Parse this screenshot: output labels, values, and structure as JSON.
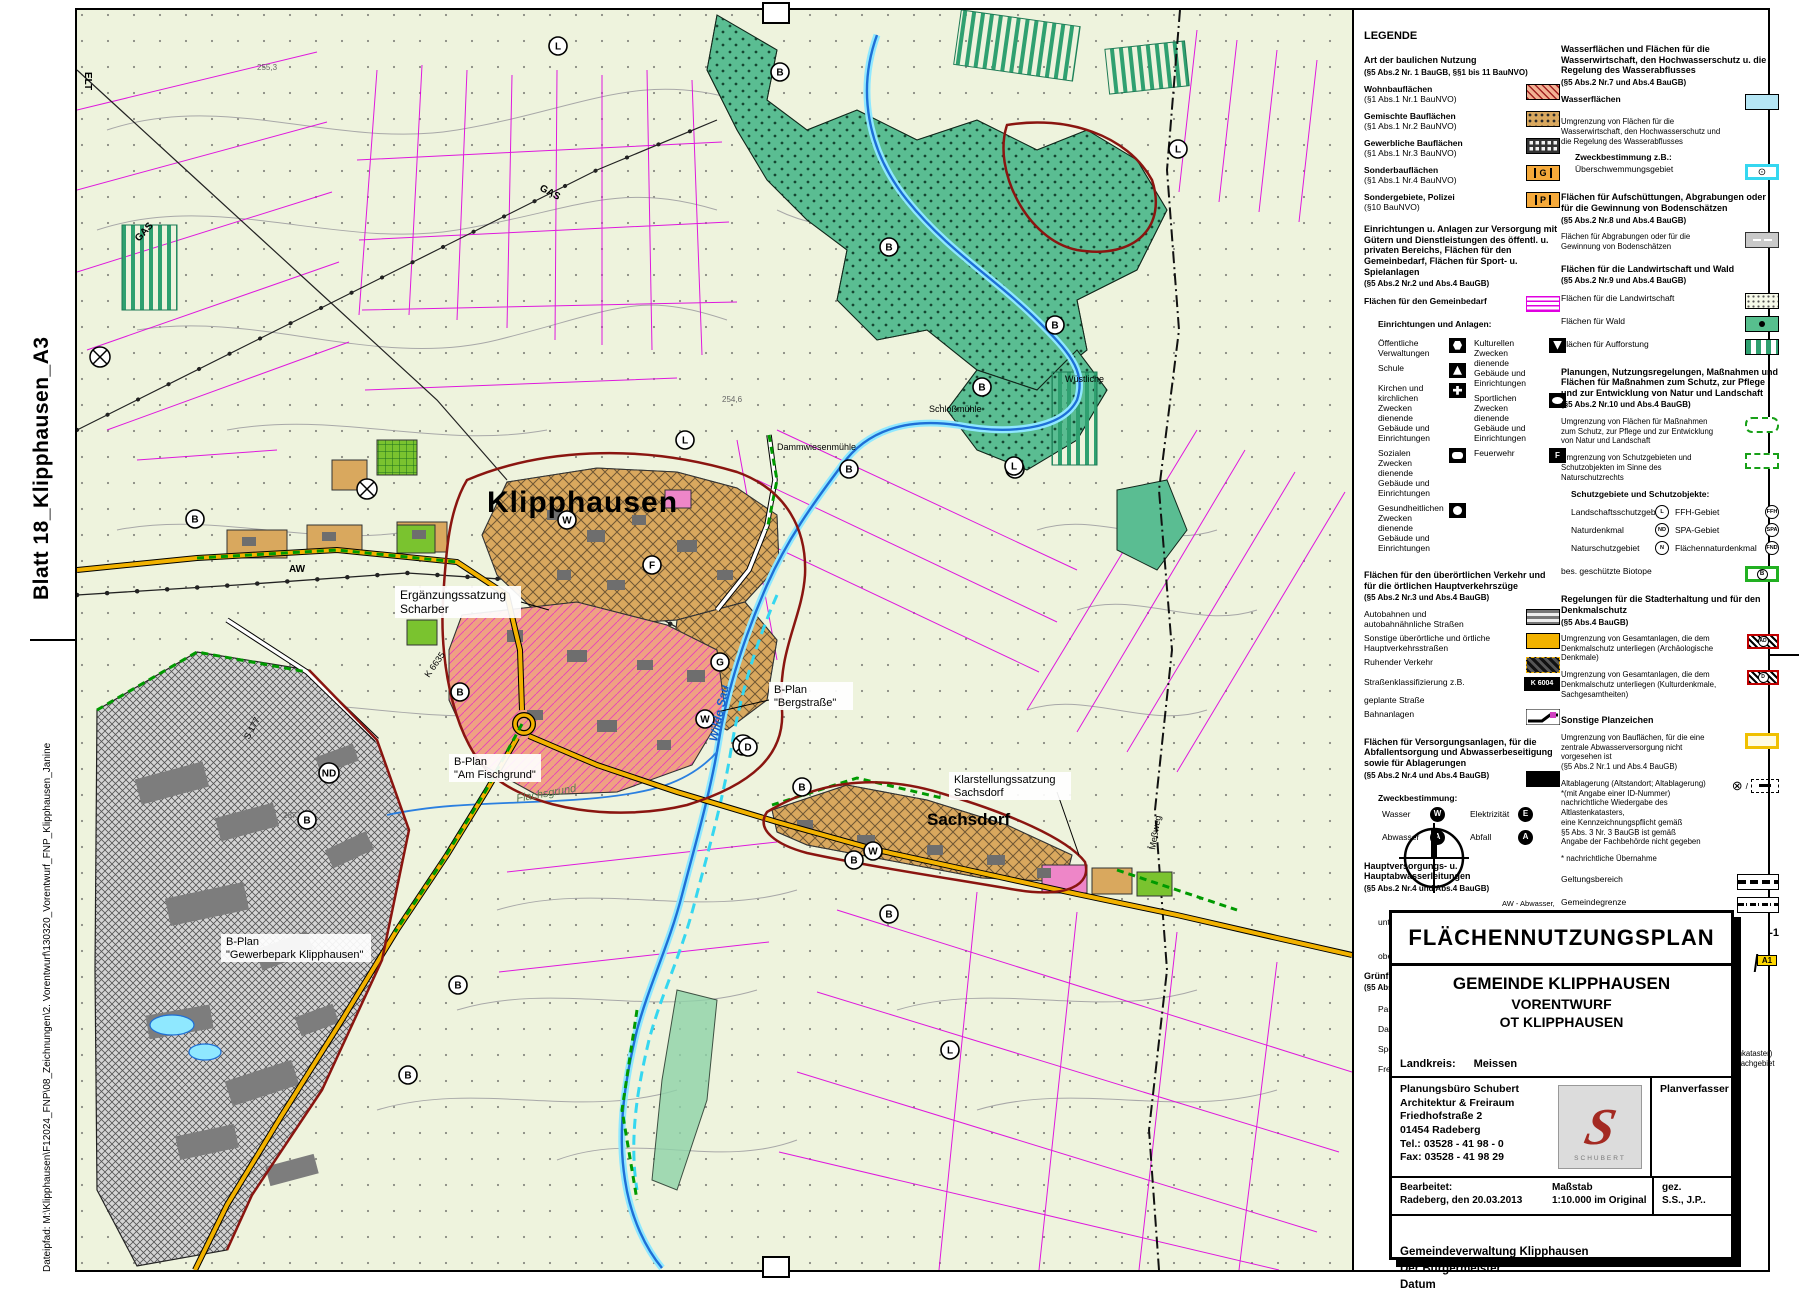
{
  "sheet": {
    "side_top": "Blatt 18_Klipphausen_A3",
    "side_bottom": "Dateipfad:   M:\\Klipphausen\\F12024_FNP\\08_Zeichnungen\\2. Vorentwurf\\130320_Vorentwurf_FNP_Klipphausen_Janine"
  },
  "colors": {
    "forest_green": "#5abd92",
    "built_mixed": "#d9a85e",
    "residential_salmon": "#efa183",
    "special_pink": "#ee86c8",
    "water_blue": "#1e6fd6",
    "flood_cyan": "#35d7f0",
    "road_yellow": "#f2b200",
    "boundary_red": "#8a1510",
    "parcel_magenta": "#dd00dd",
    "green_space": "#54bb2e"
  },
  "map": {
    "town_label": "Klipphausen",
    "village_label": "Sachsdorf",
    "annotations": {
      "erg1": "Ergänzungssatzung",
      "erg2": "Scharber",
      "fisch1": "B-Plan",
      "fisch2": "\"Am Fischgrund\"",
      "berg1": "B-Plan",
      "berg2": "\"Bergstraße\"",
      "klar1": "Klarstellungssatzung",
      "klar2": "Sachsdorf",
      "gew1": "B-Plan",
      "gew2": "\"Gewerbepark Klipphausen\"",
      "flachsgrund": "Flachsgrund",
      "wilde_sau": "Wilde Sau",
      "schlossmuehle": "Schloßmühle",
      "dammwiesenmuehle": "Dammwiesenmühle",
      "wuestliche": "Wüstliche",
      "aw": "AW",
      "gas1": "GAS",
      "gas2": "GAS",
      "elt": "ELT",
      "s177": "S 177",
      "k6635": "K 6635",
      "messweg": "Meßweg",
      "h2546": "254,6",
      "h2553": "255,3",
      "h287": "287"
    },
    "markers": [
      {
        "t": "B",
        "x": 703,
        "y": 62
      },
      {
        "t": "B",
        "x": 812,
        "y": 237
      },
      {
        "t": "B",
        "x": 978,
        "y": 315
      },
      {
        "t": "B",
        "x": 905,
        "y": 377
      },
      {
        "t": "B",
        "x": 772,
        "y": 459
      },
      {
        "t": "B",
        "x": 938,
        "y": 459
      },
      {
        "t": "B",
        "x": 118,
        "y": 509
      },
      {
        "t": "B",
        "x": 383,
        "y": 682
      },
      {
        "t": "B",
        "x": 331,
        "y": 1065
      },
      {
        "t": "B",
        "x": 725,
        "y": 777
      },
      {
        "t": "B",
        "x": 777,
        "y": 850
      },
      {
        "t": "B",
        "x": 812,
        "y": 904
      },
      {
        "t": "B",
        "x": 230,
        "y": 810
      },
      {
        "t": "B",
        "x": 381,
        "y": 975
      },
      {
        "t": "L",
        "x": 481,
        "y": 36
      },
      {
        "t": "L",
        "x": 608,
        "y": 430
      },
      {
        "t": "L",
        "x": 937,
        "y": 456
      },
      {
        "t": "L",
        "x": 1101,
        "y": 139
      },
      {
        "t": "L",
        "x": 873,
        "y": 1040
      },
      {
        "t": "W",
        "x": 490,
        "y": 510
      },
      {
        "t": "W",
        "x": 628,
        "y": 709
      },
      {
        "t": "W",
        "x": 796,
        "y": 841
      },
      {
        "t": "G",
        "x": 643,
        "y": 652
      },
      {
        "t": "ND",
        "x": 252,
        "y": 763
      },
      {
        "t": "D",
        "x": 671,
        "y": 737
      },
      {
        "t": "F",
        "x": 575,
        "y": 555
      }
    ]
  },
  "legend": {
    "title": "LEGENDE",
    "a_title": "Art der baulichen Nutzung",
    "a_sub": "(§5 Abs.2 Nr. 1 BauGB, §§1 bis 11 BauNVO)",
    "a_items": [
      {
        "l": "Wohnbauflächen",
        "s": "(§1 Abs.1 Nr.1 BauNVO)"
      },
      {
        "l": "Gemischte Bauflächen",
        "s": "(§1 Abs.1 Nr.2 BauNVO)"
      },
      {
        "l": "Gewerbliche Bauflächen",
        "s": "(§1 Abs.1 Nr.3 BauNVO)"
      },
      {
        "l": "Sonderbauflächen",
        "s": "(§1 Abs.1 Nr.4 BauNVO)"
      },
      {
        "l": "Sondergebiete, Polizei",
        "s": "(§10 BauNVO)"
      }
    ],
    "sonder_glyph1": "G",
    "sonder_glyph2": "P",
    "b_title": "Einrichtungen u. Anlagen zur Versorgung mit Gütern und Dienstleistungen des öffentl. u. privaten Bereichs, Flächen für den Gemeinbedarf, Flächen für Sport- u. Spielanlagen",
    "b_sub": "(§5 Abs.2 Nr.2 und Abs.4 BauGB)",
    "b_gemeinbedarf": "Flächen für den Gemeinbedarf",
    "b_einrichtungen": "Einrichtungen und Anlagen:",
    "b_left": [
      "Öffentliche Verwaltungen",
      "Schule",
      "Kirchen und kirchlichen Zwecken dienende Gebäude und Einrichtungen",
      "Sozialen Zwecken dienende Gebäude und Einrichtungen",
      "Gesundheitlichen Zwecken dienende Gebäude und Einrichtungen"
    ],
    "b_right": [
      "Kulturellen Zwecken dienende Gebäude und Einrichtungen",
      "Sportlichen Zwecken dienende Gebäude und Einrichtungen",
      "Feuerwehr"
    ],
    "feuerwehr_glyph": "F",
    "c_title": "Flächen für den überörtlichen Verkehr und für die örtlichen Hauptverkehrszüge",
    "c_sub": "(§5 Abs.2 Nr.3 und Abs.4 BauGB)",
    "c_items": [
      "Autobahnen und autobahnähnliche Straßen",
      "Sonstige überörtliche und örtliche Hauptverkehrsstraßen",
      "Ruhender Verkehr",
      "Straßenklassifizierung z.B.",
      "geplante Straße",
      "Bahnanlagen"
    ],
    "c_strassenkl_val": "K 6004",
    "d_title": "Flächen für Versorgungsanlagen, für die Abfallentsorgung und Abwasserbeseitigung sowie für Ablagerungen",
    "d_sub": "(§5 Abs.2 Nr.4 und Abs.4 BauGB)",
    "d_zweck": "Zweckbestimmung:",
    "d_items": [
      "Wasser",
      "Abwasser",
      "Elektrizität",
      "Abfall"
    ],
    "d_glyphs": [
      "W",
      "A",
      "E",
      "A"
    ],
    "e_title": "Hauptversorgungs- u. Hauptabwasserleitungen",
    "e_sub": "(§5 Abs.2 Nr.4 und Abs.4 BauGB)",
    "e_unter": "unterirdisch",
    "e_ober": "oberirdisch",
    "e_unter_note1": "AW - Abwasser,",
    "e_unter_note2": "TW - Trinkwasser,",
    "e_unter_note3": "GAS - Ferngasleitung",
    "e_ober_note": "ELT - Freileitung",
    "f_title": "Grünflächen",
    "f_sub": "(§5 Abs.2 Nr.5 und Abs.4 BauGB)",
    "f_left": [
      "Parkanlage",
      "Dauerkleingärten",
      "Sportplatz",
      "Freibad"
    ],
    "f_right": [
      "Spielplatz",
      "Friedhof",
      "Zeltplatz"
    ],
    "g_title": "Wasserflächen und Flächen für die Wasserwirtschaft, den Hochwasserschutz u. die Regelung des Wasserabflusses",
    "g_sub": "(§5 Abs.2 Nr.7 und Abs.4 BauGB)",
    "g_wasser": "Wasserflächen",
    "g_umgrenzung": "Umgrenzung von Flächen für die Wasserwirtschaft, den Hochwasserschutz und die Regelung des Wasserabflusses",
    "g_zweck": "Zweckbestimmung z.B.:",
    "g_ueberschwemmung": "Überschwemmungsgebiet",
    "h_title": "Flächen für Aufschüttungen, Abgrabungen oder für die Gewinnung von Bodenschätzen",
    "h_sub": "(§5 Abs.2 Nr.8 und Abs.4 BauGB)",
    "h_item": "Flächen für Abgrabungen oder für die Gewinnung von Bodenschätzen",
    "i_title": "Flächen für die Landwirtschaft und Wald",
    "i_sub": "(§5 Abs.2 Nr.9 und Abs.4 BauGB)",
    "i_items": [
      "Flächen für die Landwirtschaft",
      "Flächen für Wald",
      "Flächen für Aufforstung"
    ],
    "j_title": "Planungen, Nutzungsregelungen, Maßnahmen und Flächen für Maßnahmen zum Schutz, zur Pflege und zur Entwicklung von Natur und Landschaft",
    "j_sub": "(§5 Abs.2 Nr.10 und Abs.4 BauGB)",
    "j_item1": "Umgrenzung von Flächen für Maßnahmen zum Schutz, zur Pflege und zur Entwicklung von Natur und Landschaft",
    "j_item2": "Umgrenzung von Schutzgebieten und Schutzobjekten im Sinne des Naturschutzrechts",
    "j_schutz": "Schutzgebiete und Schutzobjekte:",
    "j_left": [
      "Landschaftsschutzgebiet",
      "Naturdenkmal",
      "Naturschutzgebiet"
    ],
    "j_left_g": [
      "L",
      "ND",
      "N"
    ],
    "j_right": [
      "FFH-Gebiet",
      "SPA-Gebiet",
      "Flächennaturdenkmal"
    ],
    "j_right_g": [
      "FFH",
      "SPA",
      "FND"
    ],
    "j_biotope": "bes. geschützte Biotope",
    "j_biotope_g": "B",
    "k_title": "Regelungen für die Stadterhaltung und für den Denkmalschutz",
    "k_sub": "(§5 Abs.4 BauGB)",
    "k_item1": "Umgrenzung von Gesamtanlagen, die dem Denkmalschutz unterliegen (Archäologische Denkmale)",
    "k_item1_g": "AD",
    "k_item2": "Umgrenzung von Gesamtanlagen, die dem Denkmalschutz unterliegen (Kulturdenkmale, Sachgesamtheiten)",
    "k_item2_g": "D",
    "l_title": "Sonstige Planzeichen",
    "l_item1a": "Umgrenzung von Bauflächen, für die eine",
    "l_item1b": "zentrale Abwasserversorgung nicht vorgesehen ist",
    "l_item1c": "(§5 Abs.2 Nr.1 und Abs.4 BauGB)",
    "l_item2a": "Altablagerung (Altstandort; Altablagerung)",
    "l_item2b": "*(mit Angabe einer ID-Nummer)",
    "l_item2c": "nachrichtliche Wiedergabe des Altlastenkatasters,",
    "l_item2d": "eine Kennzeichnungspflicht gemäß",
    "l_item2e": "§5 Abs. 3 Nr. 3 BauGB ist gemäß",
    "l_item2f": "Angabe der Fachbehörde nicht gegeben",
    "l_note": "* nachrichtliche Übernahme",
    "l_geltung": "Geltungsbereich",
    "l_grenze": "Gemeindegrenze",
    "l_nummer": "Nummerierung geplante Bauflächen/ Grünfläche",
    "l_nummer_val": "-1",
    "l_plan1": "Planerische Änderungen",
    "l_plan2": "ggf. Hinweis U.L.P. rosa",
    "l_flag": "A1",
    "m_title": "Quellen",
    "m_q1a": "Archäologische Kulturdenkmale nach SächsDSchG;",
    "m_q1b": "Quelle: \"Dokumentations- und Informationssystem Archäologie\" /DIA,",
    "m_q1c": "Landesamt für Archäologie Dresden",
    "m_q2a": "Altlastenkennziffer im SALKA (Sächsisches Altlastenkataster)",
    "m_q2b": "Quelle: Auskunft Frau Thiel (Landratsamt Meißen, Sachgebiet",
    "m_q2c": "Haushalt, Koordination / Recht) vom 10.07.2012"
  },
  "titleblock": {
    "title": "FLÄCHENNUTZUNGSPLAN",
    "line1": "GEMEINDE KLIPPHAUSEN",
    "line2": "VORENTWURF",
    "line3": "OT  KLIPPHAUSEN",
    "landkreis_label": "Landkreis:",
    "landkreis_value": "Meissen",
    "office1": "Planungsbüro Schubert",
    "office2": "Architektur & Freiraum",
    "office3": "Friedhofstraße 2",
    "office4": "01454 Radeberg",
    "office5": "Tel.: 03528 - 41 98 - 0",
    "office6": "Fax: 03528 - 41 98 29",
    "logo_letter": "S",
    "logo_text": "SCHUBERT",
    "planverfasser": "Planverfasser",
    "bearbeitet_label": "Bearbeitet:",
    "bearbeitet_value": "Radeberg, den 20.03.2013",
    "massstab_label": "Maßstab",
    "massstab_value": "1:10.000 im Original",
    "gez_label": "gez.",
    "gez_value": "S.S., J.P..",
    "footer1": "Gemeindeverwaltung Klipphausen",
    "footer2": "Der Bürgermeister",
    "footer3": "Datum"
  }
}
